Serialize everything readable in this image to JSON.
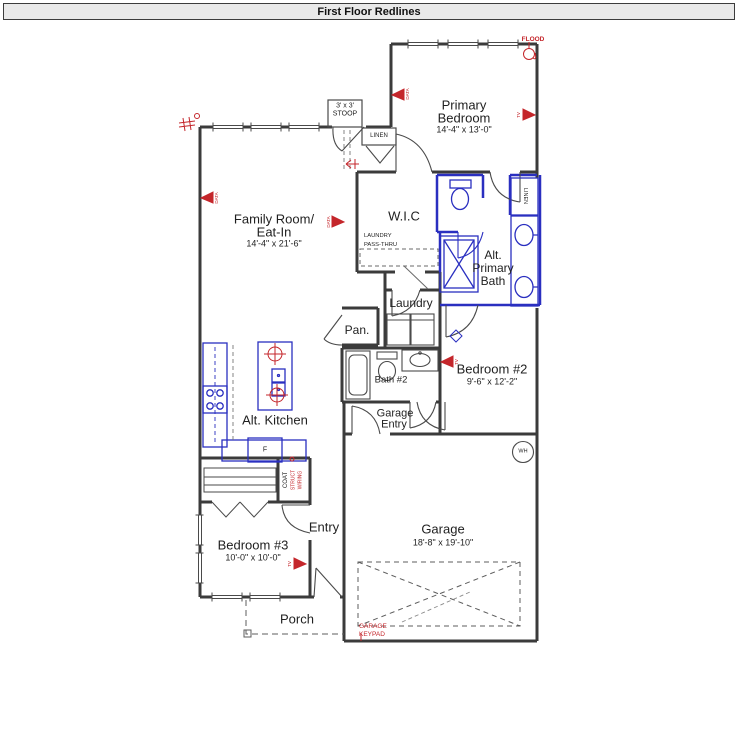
{
  "window": {
    "title": "First Floor Redlines"
  },
  "colors": {
    "wall": "#3b3b3b",
    "redline": "#c4262b",
    "blueline": "#2a2fc0",
    "titlebar_bg": "#e9e9e9"
  },
  "rooms": {
    "primary_bedroom": {
      "name_line1": "Primary",
      "name_line2": "Bedroom",
      "dims": "14'-4\" x 13'-0\""
    },
    "family_room": {
      "name_line1": "Family Room/",
      "name_line2": "Eat-In",
      "dims": "14'-4\" x 21'-6\""
    },
    "wic": {
      "name": "W.I.C"
    },
    "alt_primary_bath": {
      "name_line1": "Alt.",
      "name_line2": "Primary",
      "name_line3": "Bath"
    },
    "laundry": {
      "name": "Laundry"
    },
    "pantry": {
      "name": "Pan."
    },
    "bath2": {
      "name": "Bath #2"
    },
    "bedroom2": {
      "name": "Bedroom #2",
      "dims": "9'-6\" x 12'-2\""
    },
    "garage_entry": {
      "name_line1": "Garage",
      "name_line2": "Entry"
    },
    "alt_kitchen": {
      "name": "Alt. Kitchen"
    },
    "bedroom3": {
      "name": "Bedroom #3",
      "dims": "10'-0\" x 10'-0\""
    },
    "entry": {
      "name": "Entry"
    },
    "garage": {
      "name": "Garage",
      "dims": "18'-8\" x 19'-10\""
    },
    "porch": {
      "name": "Porch"
    },
    "stoop": {
      "line1": "3' x 3'",
      "line2": "STOOP"
    }
  },
  "closets": {
    "linen_top": "LINEN",
    "linen_bath": "LINEN",
    "coat": "COAT"
  },
  "fixtures": {
    "water_heater": "WH",
    "fridge": "F"
  },
  "annotations": {
    "flood": "FLOOD",
    "laundry_pass_thru_line1": "LAUNDRY",
    "laundry_pass_thru_line2": "PASS-THRU",
    "garage_keypad_line1": "GARAGE",
    "garage_keypad_line2": "KEYPAD",
    "struct_wiring_line1": "STRUCT",
    "struct_wiring_line2": "WIRING",
    "markers": {
      "family_room_data": "DATA",
      "primary_left_data": "DATA",
      "primary_right_tv": "TV",
      "wic_data": "DATA",
      "bedroom2_tv": "TV",
      "bedroom3_tv": "TV"
    }
  }
}
